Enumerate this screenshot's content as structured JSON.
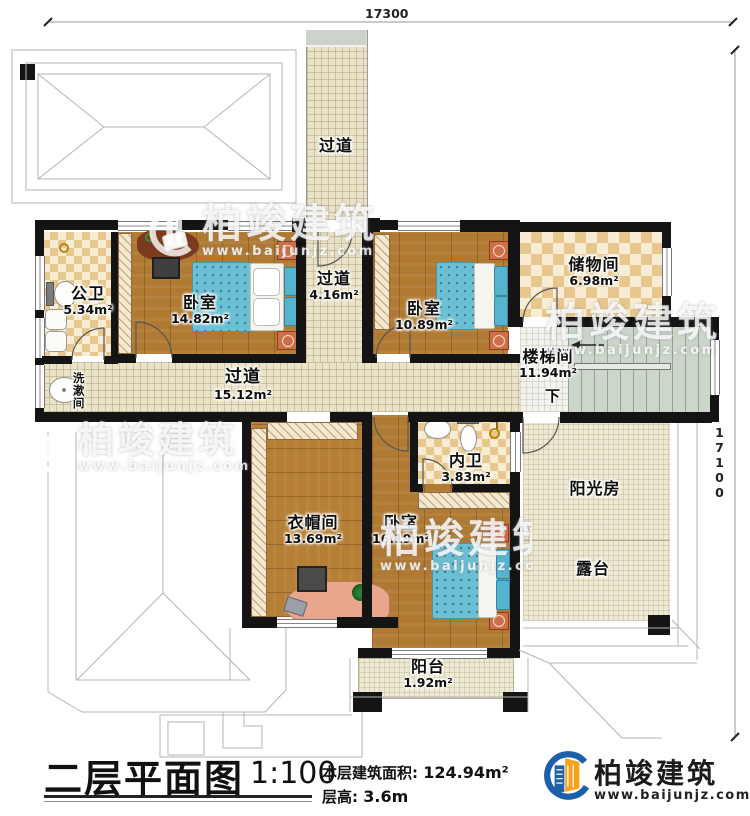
{
  "dimensions": {
    "top": "17300",
    "right": "17100"
  },
  "rooms": {
    "corridor_top": {
      "name": "过道"
    },
    "public_bath": {
      "name": "公卫",
      "area": "5.34m²"
    },
    "bedroom1": {
      "name": "卧室",
      "area": "14.82m²"
    },
    "corridor_mid": {
      "name": "过道",
      "area": "4.16m²"
    },
    "bedroom2": {
      "name": "卧室",
      "area": "10.89m²"
    },
    "storage": {
      "name": "储物间",
      "area": "6.98m²"
    },
    "stairwell": {
      "name": "楼梯间",
      "area": "11.94m²",
      "direction": "下"
    },
    "washroom": {
      "name": "洗漱间"
    },
    "corridor_main": {
      "name": "过道",
      "area": "15.12m²"
    },
    "cloakroom": {
      "name": "衣帽间",
      "area": "13.69m²"
    },
    "inner_bath": {
      "name": "内卫",
      "area": "3.83m²"
    },
    "bedroom3": {
      "name": "卧室",
      "area": "16.19m²"
    },
    "sunroom": {
      "name": "阳光房"
    },
    "terrace": {
      "name": "露台"
    },
    "balcony": {
      "name": "阳台",
      "area": "1.92m²"
    }
  },
  "title_block": {
    "title": "二层平面图",
    "scale": "1:100",
    "area_label": "本层建筑面积:",
    "area_value": "124.94m²",
    "floor_height_label": "层高:",
    "floor_height_value": "3.6m"
  },
  "branding": {
    "company": "柏竣建筑",
    "website": "www.baijunjz.com"
  },
  "watermark": {
    "company": "柏竣建筑",
    "website": "www.baijunjz.com"
  },
  "colors": {
    "wall": "#141414",
    "bed": "#6cc0d4",
    "logo_blue": "#1d5fa8",
    "logo_orange": "#f5a11c"
  }
}
